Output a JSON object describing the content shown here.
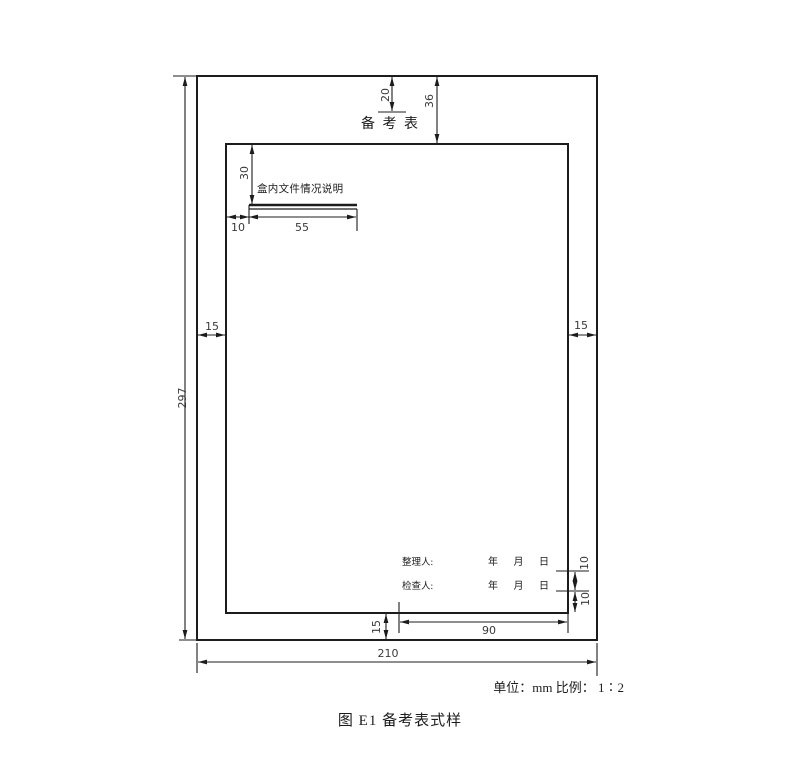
{
  "colors": {
    "ink": "#1c1c1c",
    "paper": "#ffffff"
  },
  "drawing": {
    "title": "备 考 表",
    "note": "盒内文件情况说明",
    "organizer_label": "整理人:",
    "organizer_date": "年 月 日",
    "checker_label": "检查人:",
    "checker_date": "年 月 日"
  },
  "dims": {
    "page_height": "297",
    "page_width": "210",
    "margin_top": "36",
    "title_drop": "20",
    "note_drop": "30",
    "margin_left": "15",
    "margin_right": "15",
    "margin_bottom": "15",
    "note_indent": "10",
    "note_rule_len": "55",
    "row_gap_upper": "10",
    "row_gap_lower": "10",
    "footer_rule_len": "90"
  },
  "footer": {
    "unit_scale": "单位：mm 比例： 1∶2",
    "caption": "图 E1 备考表式样"
  }
}
